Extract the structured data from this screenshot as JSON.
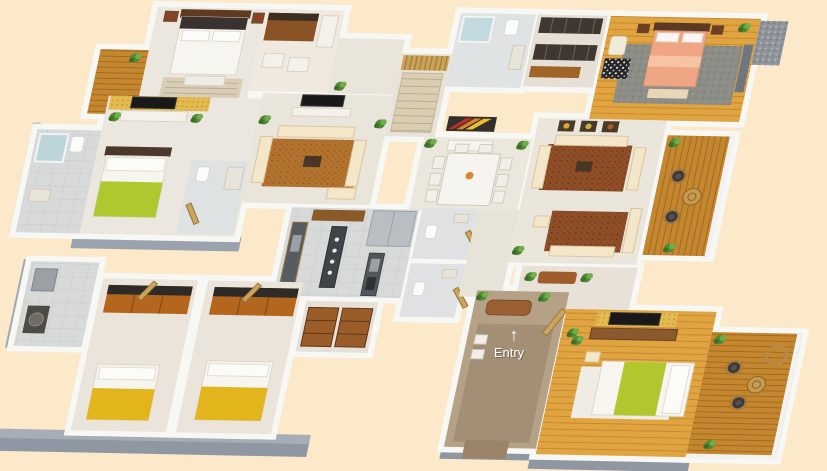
{
  "scene": {
    "type": "3d-floor-plan-render",
    "entry": {
      "label": "Entry",
      "arrow": "↑"
    }
  },
  "palette": {
    "background": "#fbe9ca",
    "wall": "#f7f7f4",
    "wall_shadow": "#98a0ab",
    "wall_shadow_dark": "#8a919d",
    "floor_light": "#ece7de",
    "floor_gray": "#d8dada",
    "wood_floor": "#e0a440",
    "deck_wood": "#c4862e",
    "honeycomb_wall": "#e3ba50",
    "sofa_cream": "#f3e6c9",
    "rug_brown": "#b3732f",
    "rug_maroon": "#8f4e28",
    "bed_lime": "#aec92f",
    "bed_mustard": "#e3b51c",
    "bed_peach": "#efa685",
    "foyer_tile": "#b4a186",
    "plant_green": "#4e8a34",
    "dark_wood": "#5f3a20",
    "mid_wood": "#8a5a2e",
    "orange_wood": "#b4661f",
    "appliance_steel": "#b9bec2",
    "tv_black": "#191919"
  }
}
